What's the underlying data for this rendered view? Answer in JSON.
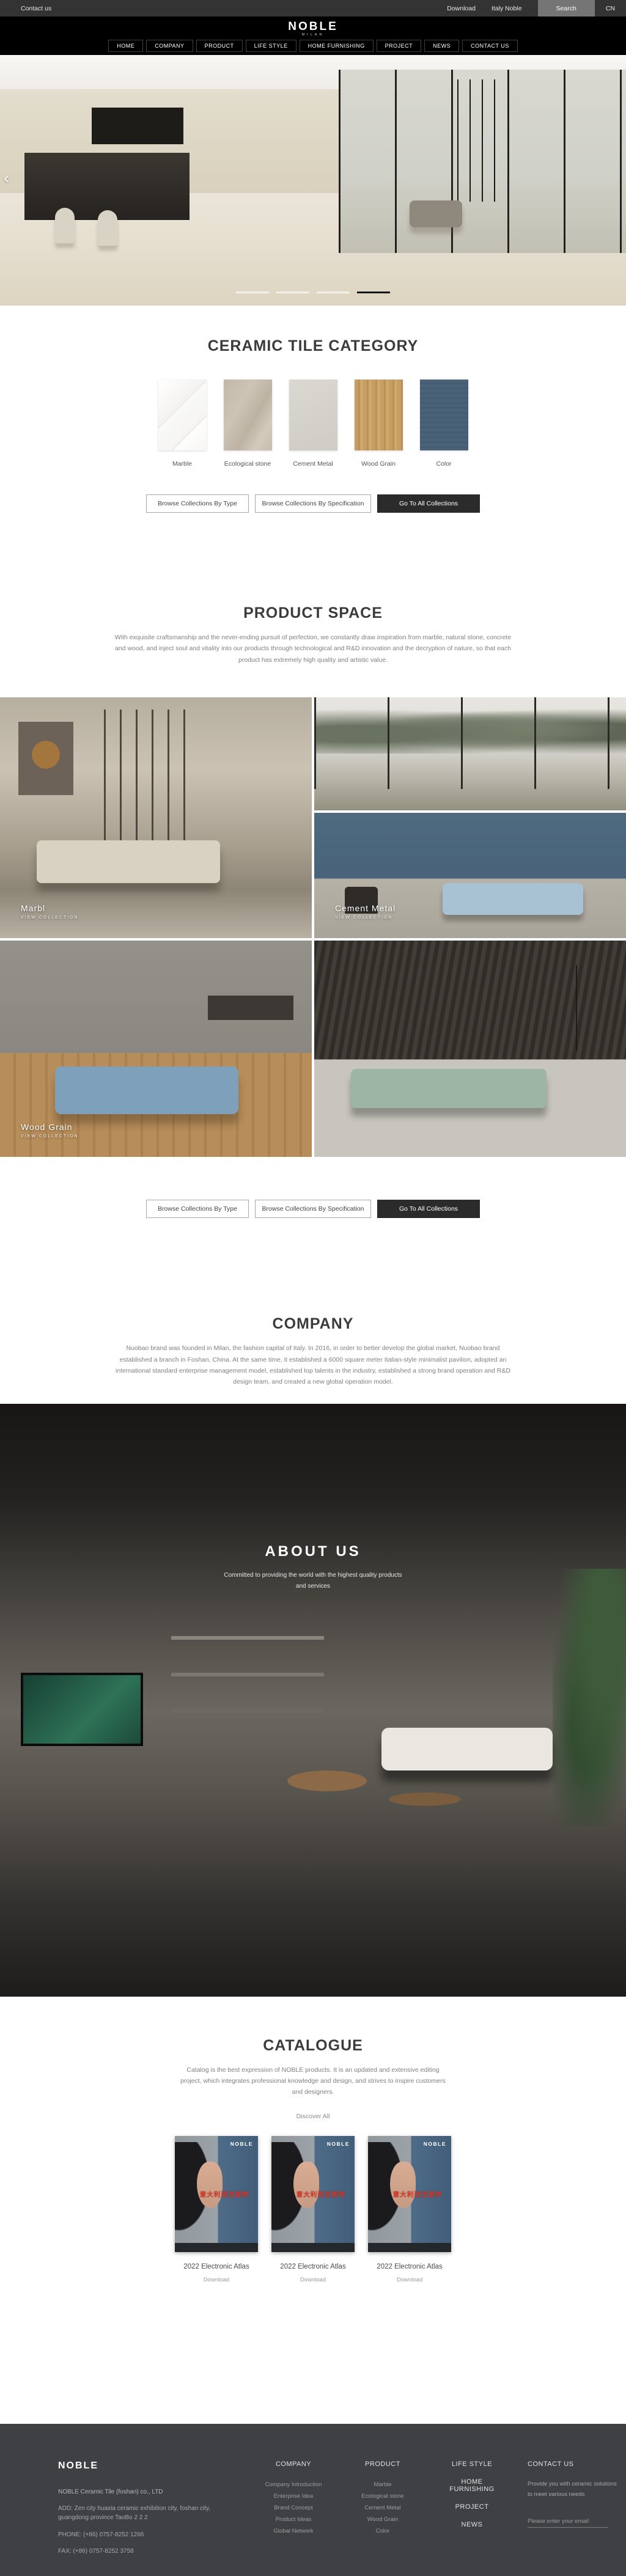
{
  "colors": {
    "topbar_bg": "#333333",
    "header_bg": "#000000",
    "footer_bg": "#3e4043",
    "dark_button": "#2b2b2b",
    "cover_red": "#d23527",
    "tile_color_blue": "#4a6277"
  },
  "topbar": {
    "contact_us": "Contact us",
    "download": "Download",
    "italy_noble": "Italy Noble",
    "search": "Search",
    "language": "CN"
  },
  "header": {
    "logo": "NOBLE",
    "logo_sub": "MILAN",
    "nav": [
      "HOME",
      "COMPANY",
      "PRODUCT",
      "LIFE STYLE",
      "HOME FURNISHING",
      "PROJECT",
      "NEWS",
      "CONTACT US"
    ]
  },
  "hero": {
    "prev_arrow": "‹"
  },
  "collection_buttons": {
    "by_type": "Browse Collections By Type",
    "by_spec": "Browse Collections By Specification",
    "all": "Go To All Collections"
  },
  "category": {
    "title": "CERAMIC TILE CATEGORY",
    "tiles": [
      {
        "label": "Marble"
      },
      {
        "label": "Ecological stone"
      },
      {
        "label": "Cement Metal"
      },
      {
        "label": "Wood Grain"
      },
      {
        "label": "Color"
      }
    ]
  },
  "product_space": {
    "title": "PRODUCT SPACE",
    "description": "With exquisite craftsmanship and the never-ending pursuit of perfection, we constantly draw inspiration from marble, natural stone, concrete and wood, and inject soul and vitality into our products through technological and R&D innovation and the decryption of nature, so that each product has extremely high quality and artistic value.",
    "cards": [
      {
        "label": "Marbl",
        "sub": "VIEW COLLECTION"
      },
      {
        "label": "Cement Metal",
        "sub": "VIEW COLLECTION"
      },
      {
        "label": "Wood Grain",
        "sub": "VIEW COLLECTION"
      }
    ]
  },
  "company": {
    "title": "COMPANY",
    "description": "Nuobao brand was founded in Milan, the fashion capital of Italy. In 2016, in order to better develop the global market, Nuobao brand established a branch in Foshan, China. At the same time, it established a 6000 square meter Italian-style minimalist pavilion, adopted an international standard enterprise management model, established top talents in the industry, established a strong brand operation and R&D design team, and created a new global operation model."
  },
  "about": {
    "title": "ABOUT US",
    "tagline1": "Committed to providing the world with the highest quality products",
    "tagline2": "and services"
  },
  "catalogue": {
    "title": "CATALOGUE",
    "description": "Catalog is the best expression of NOBLE products. It is an updated and extensive editing project, which integrates professional knowledge and design, and strives to inspire customers and designers.",
    "discover_all": "Discover All",
    "items": [
      {
        "cover_logo": "NOBLE",
        "cover_title": "意大利诺宝瓷砖",
        "name": "2022 Electronic Atlas",
        "download": "Download"
      },
      {
        "cover_logo": "NOBLE",
        "cover_title": "意大利诺宝瓷砖",
        "name": "2022 Electronic Atlas",
        "download": "Download"
      },
      {
        "cover_logo": "NOBLE",
        "cover_title": "意大利诺宝瓷砖",
        "name": "2022 Electronic Atlas",
        "download": "Download"
      }
    ]
  },
  "footer": {
    "logo": "NOBLE",
    "company_name": "NOBLE Ceramic Tile (foshan) co., LTD",
    "address": "ADD:  Zen city huaxia ceramic exhibition city, foshan city, guangdong province TaoBo 2 2 2",
    "phone": "PHONE:   (+86)  0757-8252 1266",
    "fax": "FAX:   (+86)  0757-8252 3758",
    "columns": [
      {
        "heading": "COMPANY",
        "links": [
          "Company Introduction",
          "Enterprise Idea",
          "Brand Concept",
          "Product Ideas",
          "Global Network"
        ]
      },
      {
        "heading": "PRODUCT",
        "links": [
          "Marble",
          "Ecological stone",
          "Cement Metal",
          "Wood Grain",
          "Color"
        ]
      }
    ],
    "nav_headings": [
      "LIFE STYLE",
      "HOME FURNISHING",
      "PROJECT",
      "NEWS"
    ],
    "contact": {
      "heading": "CONTACT US",
      "text": "Provide you with ceramic solutions to meet various needs",
      "placeholder": "Please enter your email"
    }
  }
}
